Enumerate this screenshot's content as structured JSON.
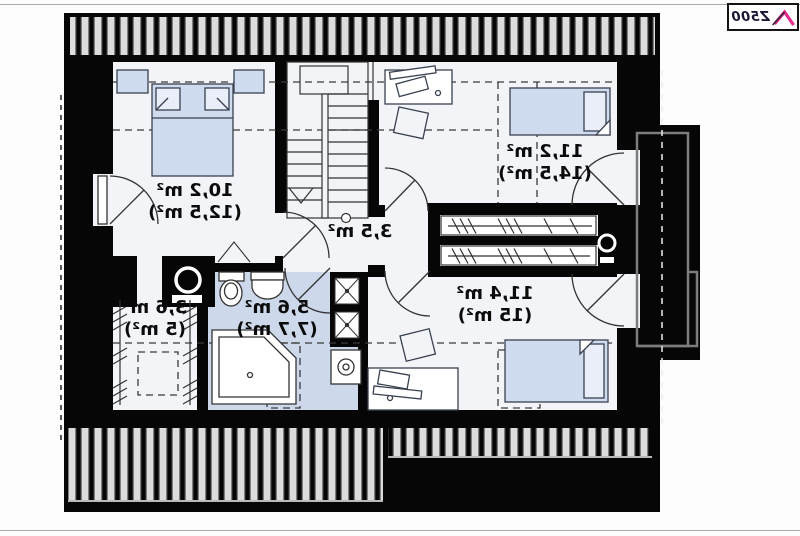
{
  "logo": {
    "text": "Z500"
  },
  "rooms": [
    {
      "id": "bedroom-left",
      "area": "10,2 m²",
      "area_total": "(12,5 m²)"
    },
    {
      "id": "bedroom-upper-right",
      "area": "11,2 m²",
      "area_total": "(14,5 m²)"
    },
    {
      "id": "hall",
      "area": "3,5 m²",
      "area_total": ""
    },
    {
      "id": "wardrobe",
      "area": "3,6 m²",
      "area_total": "(5 m²)"
    },
    {
      "id": "bathroom",
      "area": "5,6 m²",
      "area_total": "(7,7 m²)"
    },
    {
      "id": "bedroom-lower-right",
      "area": "11,4 m²",
      "area_total": "(15 m²)"
    }
  ],
  "colors": {
    "wall": "#060606",
    "floor": "#f2f4f8",
    "furniture_blue": "#cfdcf0",
    "bathroom_floor": "#cdd8eb",
    "logo_pink": "#e82b8b",
    "logo_navy": "#181836"
  }
}
